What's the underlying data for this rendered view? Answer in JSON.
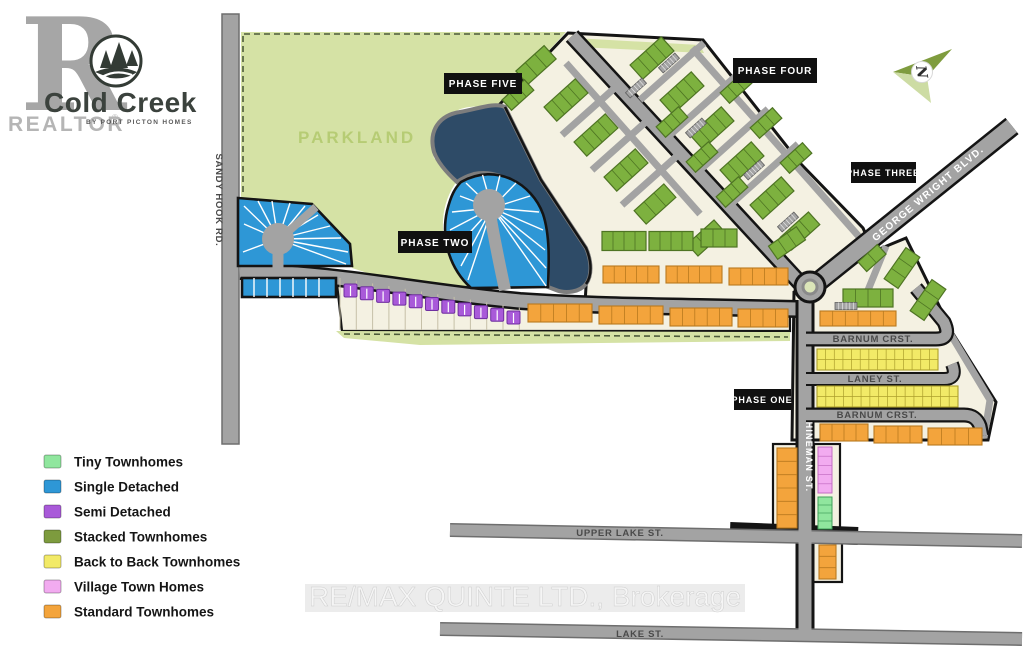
{
  "logo": {
    "brand_r": "R",
    "realtor": "REALTOR",
    "reg_mark": "®",
    "name": "Cold Creek",
    "tagline": "BY PORT PICTON HOMES"
  },
  "north_label": "N",
  "watermark": "RE/MAX QUINTE LTD., Brokerage",
  "parkland_label": "PARKLAND",
  "phases": {
    "one": "PHASE ONE",
    "two": "PHASE TWO",
    "three": "PHASE THREE",
    "four": "PHASE FOUR",
    "five": "PHASE FIVE"
  },
  "streets": {
    "sandy_hook": "SANDY HOOK RD.",
    "george_wright": "GEORGE WRIGHT BLVD.",
    "barnum_upper": "BARNUM CRST.",
    "laney": "LANEY ST.",
    "barnum_lower": "BARNUM CRST.",
    "hineman": "HINEMAN ST.",
    "upper_lake": "UPPER LAKE ST.",
    "lake": "LAKE ST."
  },
  "legend": {
    "items": [
      {
        "label": "Tiny Townhomes",
        "color": "#90e69e"
      },
      {
        "label": "Single Detached",
        "color": "#2e97d6"
      },
      {
        "label": "Semi Detached",
        "color": "#a95ad9"
      },
      {
        "label": "Stacked Townhomes",
        "color": "#7d9b3e"
      },
      {
        "label": "Back to Back Townhomes",
        "color": "#f2ea67"
      },
      {
        "label": "Village Town Homes",
        "color": "#f2abf0"
      },
      {
        "label": "Standard Townhomes",
        "color": "#f3a43c"
      }
    ]
  },
  "colors": {
    "parkland": "#d5e2a5",
    "parkland_text": "#b6cc74",
    "beige": "#f4f1e2",
    "pond": "#2e4b67",
    "road": "#a3a3a3",
    "road_edge": "#6e6e6e",
    "casing": "#141414",
    "blue": "#2e97d6",
    "green": "#7db13f",
    "green_edge": "#4e7423",
    "orange": "#f3a43c",
    "orange_edge": "#b97a1e",
    "yellow": "#f2ea67",
    "yellow_edge": "#ac9f2c",
    "pink": "#f2abf0",
    "pink_edge": "#c36cc3",
    "tiny": "#90e69e",
    "tiny_edge": "#3f9e59",
    "purple": "#a95ad9",
    "purple_edge": "#6f2fa0",
    "island": "#dbe5b8",
    "label_box": "#101010",
    "street_text": "#4a4a4a",
    "north_dark": "#7f9c3e",
    "north_light": "#cddca4",
    "gray_logo": "#9f9f9f",
    "watermark": "#f5f5f5"
  },
  "map": {
    "green_buildings": [
      {
        "x": 536,
        "y": 65,
        "w": 38,
        "h": 18,
        "r": -42
      },
      {
        "x": 566,
        "y": 100,
        "w": 42,
        "h": 19,
        "r": -42
      },
      {
        "x": 596,
        "y": 135,
        "w": 42,
        "h": 19,
        "r": -42
      },
      {
        "x": 626,
        "y": 170,
        "w": 42,
        "h": 19,
        "r": -42
      },
      {
        "x": 655,
        "y": 204,
        "w": 40,
        "h": 18,
        "r": -42
      },
      {
        "x": 518,
        "y": 95,
        "w": 30,
        "h": 14,
        "r": -42
      },
      {
        "x": 706,
        "y": 238,
        "w": 36,
        "h": 16,
        "r": -42
      },
      {
        "x": 652,
        "y": 58,
        "w": 42,
        "h": 19,
        "r": -42
      },
      {
        "x": 682,
        "y": 93,
        "w": 42,
        "h": 19,
        "r": -42
      },
      {
        "x": 712,
        "y": 128,
        "w": 42,
        "h": 19,
        "r": -42
      },
      {
        "x": 742,
        "y": 163,
        "w": 42,
        "h": 19,
        "r": -42
      },
      {
        "x": 772,
        "y": 198,
        "w": 42,
        "h": 19,
        "r": -42
      },
      {
        "x": 800,
        "y": 231,
        "w": 38,
        "h": 17,
        "r": -42
      },
      {
        "x": 672,
        "y": 122,
        "w": 30,
        "h": 14,
        "r": -42
      },
      {
        "x": 702,
        "y": 157,
        "w": 30,
        "h": 14,
        "r": -42
      },
      {
        "x": 732,
        "y": 192,
        "w": 30,
        "h": 14,
        "r": -42
      },
      {
        "x": 736,
        "y": 88,
        "w": 30,
        "h": 14,
        "r": -42
      },
      {
        "x": 766,
        "y": 123,
        "w": 30,
        "h": 14,
        "r": -42
      },
      {
        "x": 796,
        "y": 158,
        "w": 30,
        "h": 14,
        "r": -42
      },
      {
        "x": 624,
        "y": 241,
        "w": 44,
        "h": 19,
        "r": 0
      },
      {
        "x": 671,
        "y": 241,
        "w": 44,
        "h": 19,
        "r": 0
      },
      {
        "x": 719,
        "y": 238,
        "w": 36,
        "h": 18,
        "r": 0
      },
      {
        "x": 787,
        "y": 243,
        "w": 34,
        "h": 16,
        "r": -35
      },
      {
        "x": 868,
        "y": 298,
        "w": 50,
        "h": 18,
        "r": 0
      },
      {
        "x": 902,
        "y": 268,
        "w": 38,
        "h": 17,
        "r": -55
      },
      {
        "x": 928,
        "y": 300,
        "w": 38,
        "h": 17,
        "r": -55
      },
      {
        "x": 872,
        "y": 258,
        "w": 26,
        "h": 13,
        "r": -42
      }
    ],
    "parking_strips": [
      {
        "x": 636,
        "y": 88,
        "r": -42
      },
      {
        "x": 696,
        "y": 128,
        "r": -42
      },
      {
        "x": 754,
        "y": 170,
        "r": -42
      },
      {
        "x": 669,
        "y": 63,
        "r": -42
      },
      {
        "x": 788,
        "y": 222,
        "r": -42
      },
      {
        "x": 846,
        "y": 306,
        "r": 0
      }
    ],
    "orange_strips": [
      {
        "x": 603,
        "y": 266,
        "w": 56,
        "h": 17,
        "u": 5
      },
      {
        "x": 666,
        "y": 266,
        "w": 56,
        "h": 17,
        "u": 5
      },
      {
        "x": 729,
        "y": 268,
        "w": 59,
        "h": 17,
        "u": 5
      },
      {
        "x": 528,
        "y": 304,
        "w": 64,
        "h": 18,
        "u": 5
      },
      {
        "x": 599,
        "y": 306,
        "w": 64,
        "h": 18,
        "u": 5
      },
      {
        "x": 670,
        "y": 308,
        "w": 62,
        "h": 18,
        "u": 5
      },
      {
        "x": 738,
        "y": 309,
        "w": 50,
        "h": 18,
        "u": 4
      },
      {
        "x": 820,
        "y": 311,
        "w": 76,
        "h": 15,
        "u": 6
      },
      {
        "x": 820,
        "y": 424,
        "w": 48,
        "h": 17,
        "u": 4
      },
      {
        "x": 874,
        "y": 426,
        "w": 48,
        "h": 17,
        "u": 4
      },
      {
        "x": 928,
        "y": 428,
        "w": 54,
        "h": 17,
        "u": 4
      },
      {
        "x": 777,
        "y": 448,
        "w": 20,
        "h": 80,
        "u": 6,
        "v": true
      },
      {
        "x": 819,
        "y": 545,
        "w": 17,
        "h": 34,
        "u": 3,
        "v": true
      }
    ],
    "yellow_strips": [
      {
        "x": 817,
        "y": 349,
        "w": 121,
        "h": 21,
        "u": 14
      },
      {
        "x": 817,
        "y": 386,
        "w": 141,
        "h": 21,
        "u": 16
      }
    ],
    "pink_strip": {
      "x": 818,
      "y": 447,
      "w": 14,
      "h": 46,
      "u": 5,
      "v": true
    },
    "tiny_strip": {
      "x": 818,
      "y": 497,
      "w": 14,
      "h": 32,
      "u": 4,
      "v": true
    },
    "semi_row": {
      "x0": 344,
      "y0": 284,
      "dx": 16.3,
      "dy": 2.7,
      "count": 11,
      "w": 13,
      "h": 13
    }
  }
}
